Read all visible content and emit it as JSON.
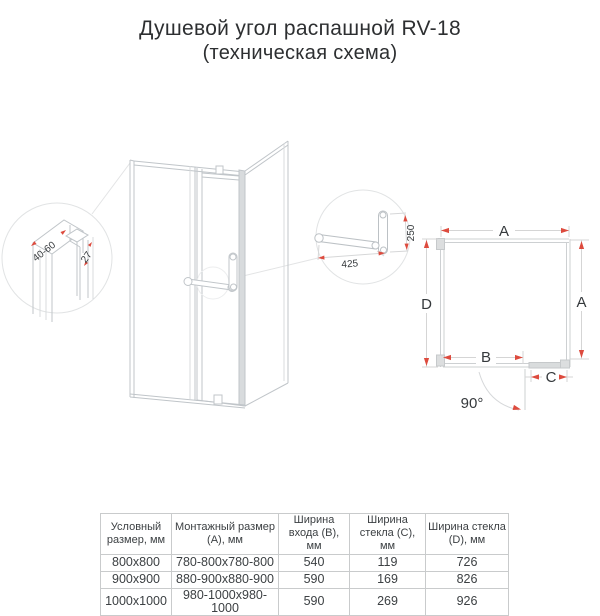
{
  "title": {
    "line1": "Душевой угол распашной RV-18",
    "line2": "(техническая схема)"
  },
  "colors": {
    "accent_red": "#dd4b3e",
    "line_gray": "#c0c5c9",
    "dim_gray": "#d2d2d2",
    "text": "#35393c"
  },
  "callouts": {
    "profile": {
      "adjust_range": "40-60",
      "profile_depth": "27"
    },
    "handle": {
      "bar_length": "425",
      "handle_height": "250"
    }
  },
  "plan": {
    "dim_top": "A",
    "dim_left": "D",
    "dim_right": "A",
    "dim_entry": "B",
    "dim_fixed": "C",
    "angle": "90°"
  },
  "table": {
    "headers": [
      "Условный размер, мм",
      "Монтажный размер (A), мм",
      "Ширина входа (B), мм",
      "Ширина стекла (C), мм",
      "Ширина стекла (D), мм"
    ],
    "rows": [
      [
        "800x800",
        "780-800x780-800",
        "540",
        "119",
        "726"
      ],
      [
        "900x900",
        "880-900x880-900",
        "590",
        "169",
        "826"
      ],
      [
        "1000x1000",
        "980-1000x980-1000",
        "590",
        "269",
        "926"
      ]
    ]
  }
}
